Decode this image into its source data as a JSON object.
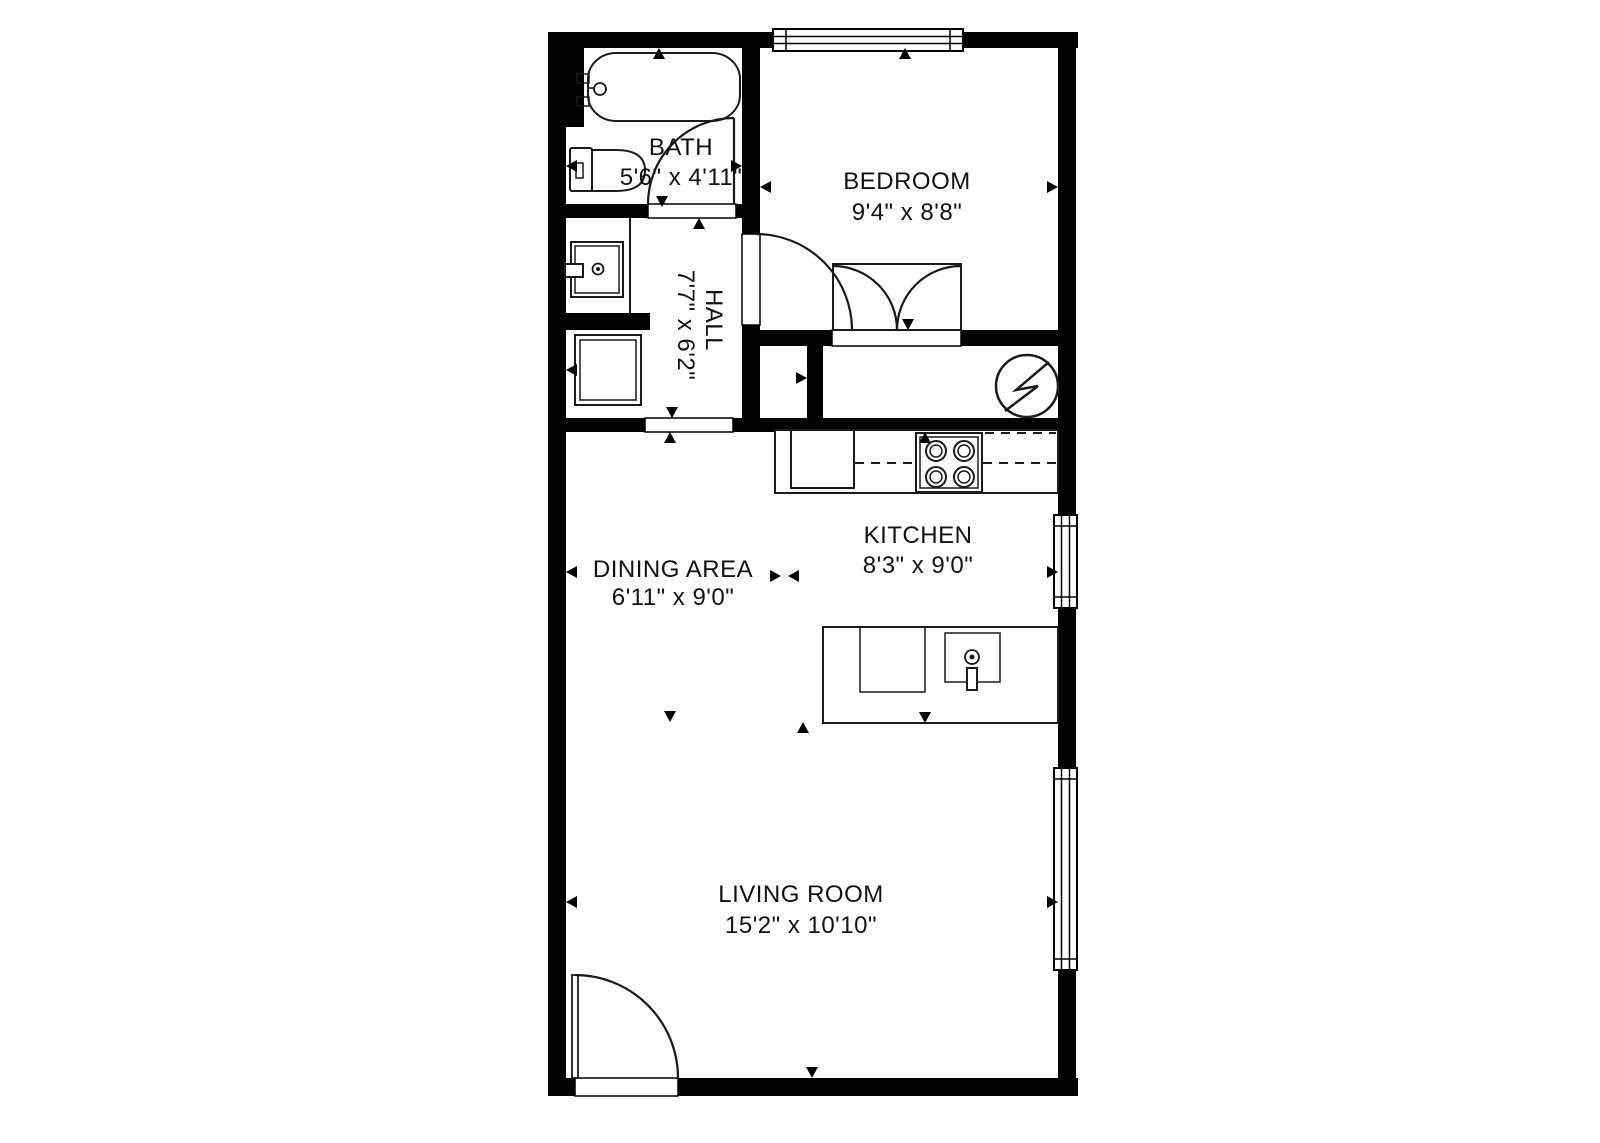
{
  "floor_plan": {
    "background_color": "#ffffff",
    "wall_color": "#000000",
    "text_color": "#111111",
    "rooms": [
      {
        "name": "BATH",
        "dimensions": "5'6\" x 4'11\""
      },
      {
        "name": "BEDROOM",
        "dimensions": "9'4\" x 8'8\""
      },
      {
        "name": "HALL",
        "dimensions": "7'7\" x 6'2\""
      },
      {
        "name": "DINING AREA",
        "dimensions": "6'11\" x 9'0\""
      },
      {
        "name": "KITCHEN",
        "dimensions": "8'3\" x 9'0\""
      },
      {
        "name": "LIVING ROOM",
        "dimensions": "15'2\" x 10'10\""
      }
    ],
    "fixtures": [
      "bathtub",
      "toilet",
      "sink-vanity",
      "washer",
      "electrical-panel",
      "refrigerator",
      "stove",
      "kitchen-island",
      "island-sink"
    ],
    "features": [
      "bedroom-window",
      "kitchen-window",
      "living-room-window",
      "bath-door",
      "bedroom-door",
      "closet-double-door",
      "entry-door"
    ]
  }
}
